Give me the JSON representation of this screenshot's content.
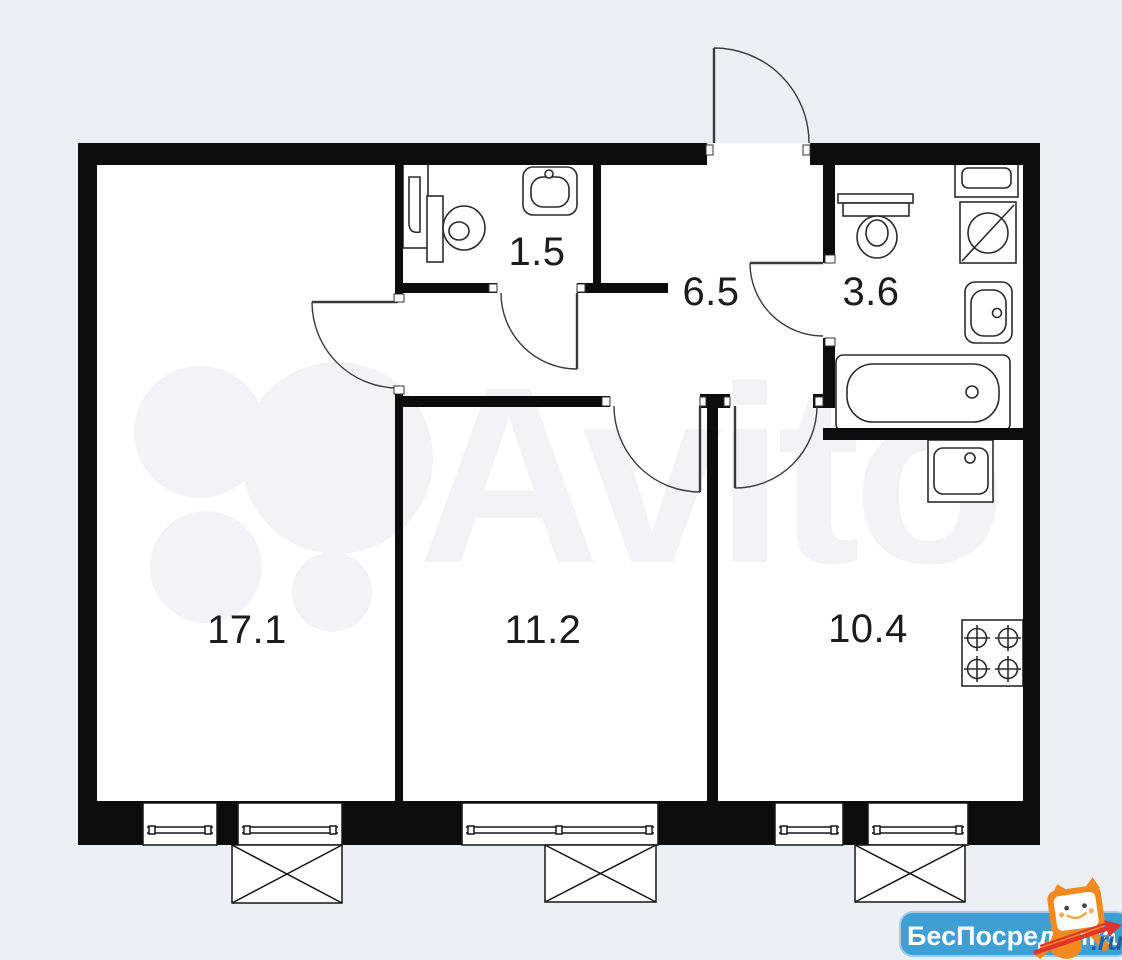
{
  "floor_plan": {
    "room_labels": [
      {
        "room": "room-17-1",
        "area": "17.1"
      },
      {
        "room": "room-11-2",
        "area": "11.2"
      },
      {
        "room": "kitchen",
        "area": "10.4"
      },
      {
        "room": "wc",
        "area": "1.5"
      },
      {
        "room": "hallway",
        "area": "6.5"
      },
      {
        "room": "bathroom",
        "area": "3.6"
      }
    ]
  },
  "watermarks": {
    "avito": "Avito",
    "beposrednika_name": "БесПосредника",
    "beposrednika_suffix": ".ru"
  },
  "colors": {
    "background": "#ECEFF5",
    "wall": "#0C0C0C",
    "floor": "#FFFFFF",
    "badge_blue": "#3F9ED3",
    "mascot_orange": "#F28A1F",
    "arrow_red": "#E2342B",
    "suffix_blue": "#1F5FA0"
  }
}
